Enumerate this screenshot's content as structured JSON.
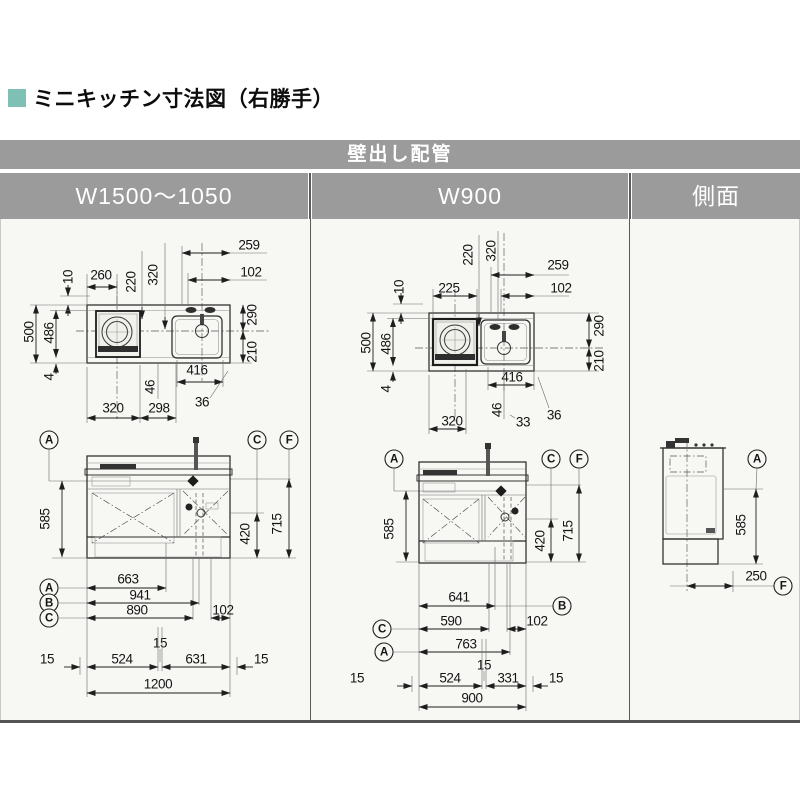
{
  "page": {
    "title": "ミニキッチン寸法図（右勝手）",
    "accent_color": "#7fc0b4"
  },
  "table": {
    "header": "壁出し配管",
    "columns": [
      {
        "label": "W1500～1050"
      },
      {
        "label": "W900"
      },
      {
        "label": "側面"
      }
    ]
  },
  "letters": {
    "a": "A",
    "b": "B",
    "c": "C",
    "f": "F"
  },
  "w1500": {
    "plan": {
      "d259": "259",
      "d102": "102",
      "d260": "260",
      "d220": "220",
      "d320": "320",
      "d10": "10",
      "d500": "500",
      "d486": "486",
      "d4": "4",
      "d290": "290",
      "d210": "210",
      "d416": "416",
      "d36": "36",
      "d46": "46",
      "d320b": "320",
      "d298": "298"
    },
    "front": {
      "d585": "585",
      "d420": "420",
      "d715": "715",
      "d663": "663",
      "d941": "941",
      "d890": "890",
      "d102": "102",
      "d15m": "15",
      "d15l": "15",
      "d524": "524",
      "d631": "631",
      "d15r": "15",
      "d1200": "1200"
    }
  },
  "w900": {
    "plan": {
      "d259": "259",
      "d102": "102",
      "d225": "225",
      "d220": "220",
      "d320": "320",
      "d10": "10",
      "d500": "500",
      "d486": "486",
      "d4": "4",
      "d290": "290",
      "d210": "210",
      "d416": "416",
      "d36": "36",
      "d46": "46",
      "d33": "33",
      "d320b": "320"
    },
    "front": {
      "d585": "585",
      "d420": "420",
      "d715": "715",
      "d641": "641",
      "d590": "590",
      "d763": "763",
      "d102": "102",
      "d15m": "15",
      "d15l": "15",
      "d524": "524",
      "d331": "331",
      "d15r": "15",
      "d900": "900"
    }
  },
  "side": {
    "d585": "585",
    "d250": "250"
  }
}
